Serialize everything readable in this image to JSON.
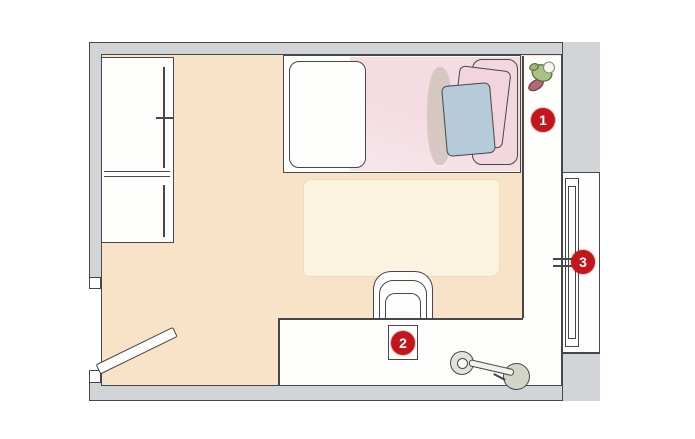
{
  "title": "Bedroom floor plan",
  "markers": [
    {
      "number": "1"
    },
    {
      "number": "2"
    },
    {
      "number": "3"
    }
  ],
  "objects": [
    "wardrobe",
    "single-bed",
    "white-pillow",
    "blue-pillow",
    "pink-pillow",
    "side-shelf",
    "potted-plant",
    "rug",
    "desk",
    "desk-chair",
    "desk-device",
    "kick-scooter",
    "window",
    "door"
  ],
  "colors": {
    "wall": "#d2d5d7",
    "outline": "#45474a",
    "floor": "#f8e3c9",
    "rug": "#fbf2df",
    "bed_blanket": "#f4dce2",
    "blanket_fold": "#f2d7de",
    "pillow_blue": "#b6cbd9",
    "pillow_pink": "#f2d4dc",
    "furniture": "#fdfdfb",
    "wheel": "#d3d5c7",
    "leaf": "#a9c183",
    "pot": "#b06a74",
    "badge": "#c2161c",
    "badge_text": "#ffffff"
  }
}
